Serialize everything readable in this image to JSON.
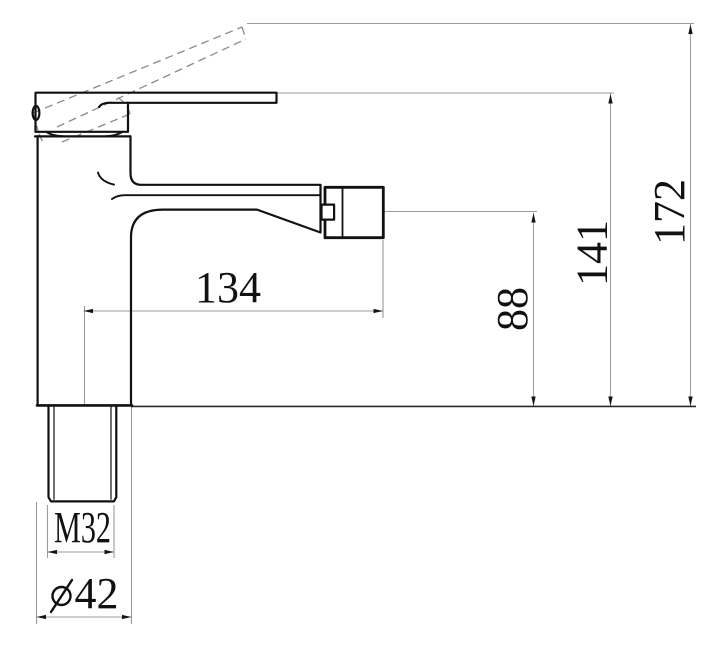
{
  "drawing": {
    "title": "faucet-dimension-drawing",
    "colors": {
      "outline": "#111111",
      "dimension_lines": "#9c9c9c",
      "dashed_lines": "#8a8a8a",
      "text": "#111111",
      "background": "#ffffff"
    },
    "dimensions": {
      "reach_134": "134",
      "spout_height_88": "88",
      "handle_height_141": "141",
      "overall_height_172": "172",
      "thread_m32": "M32",
      "base_diameter_symbol": "⌀",
      "base_diameter_value": "42",
      "base_diameter_label": "⌀42"
    }
  }
}
